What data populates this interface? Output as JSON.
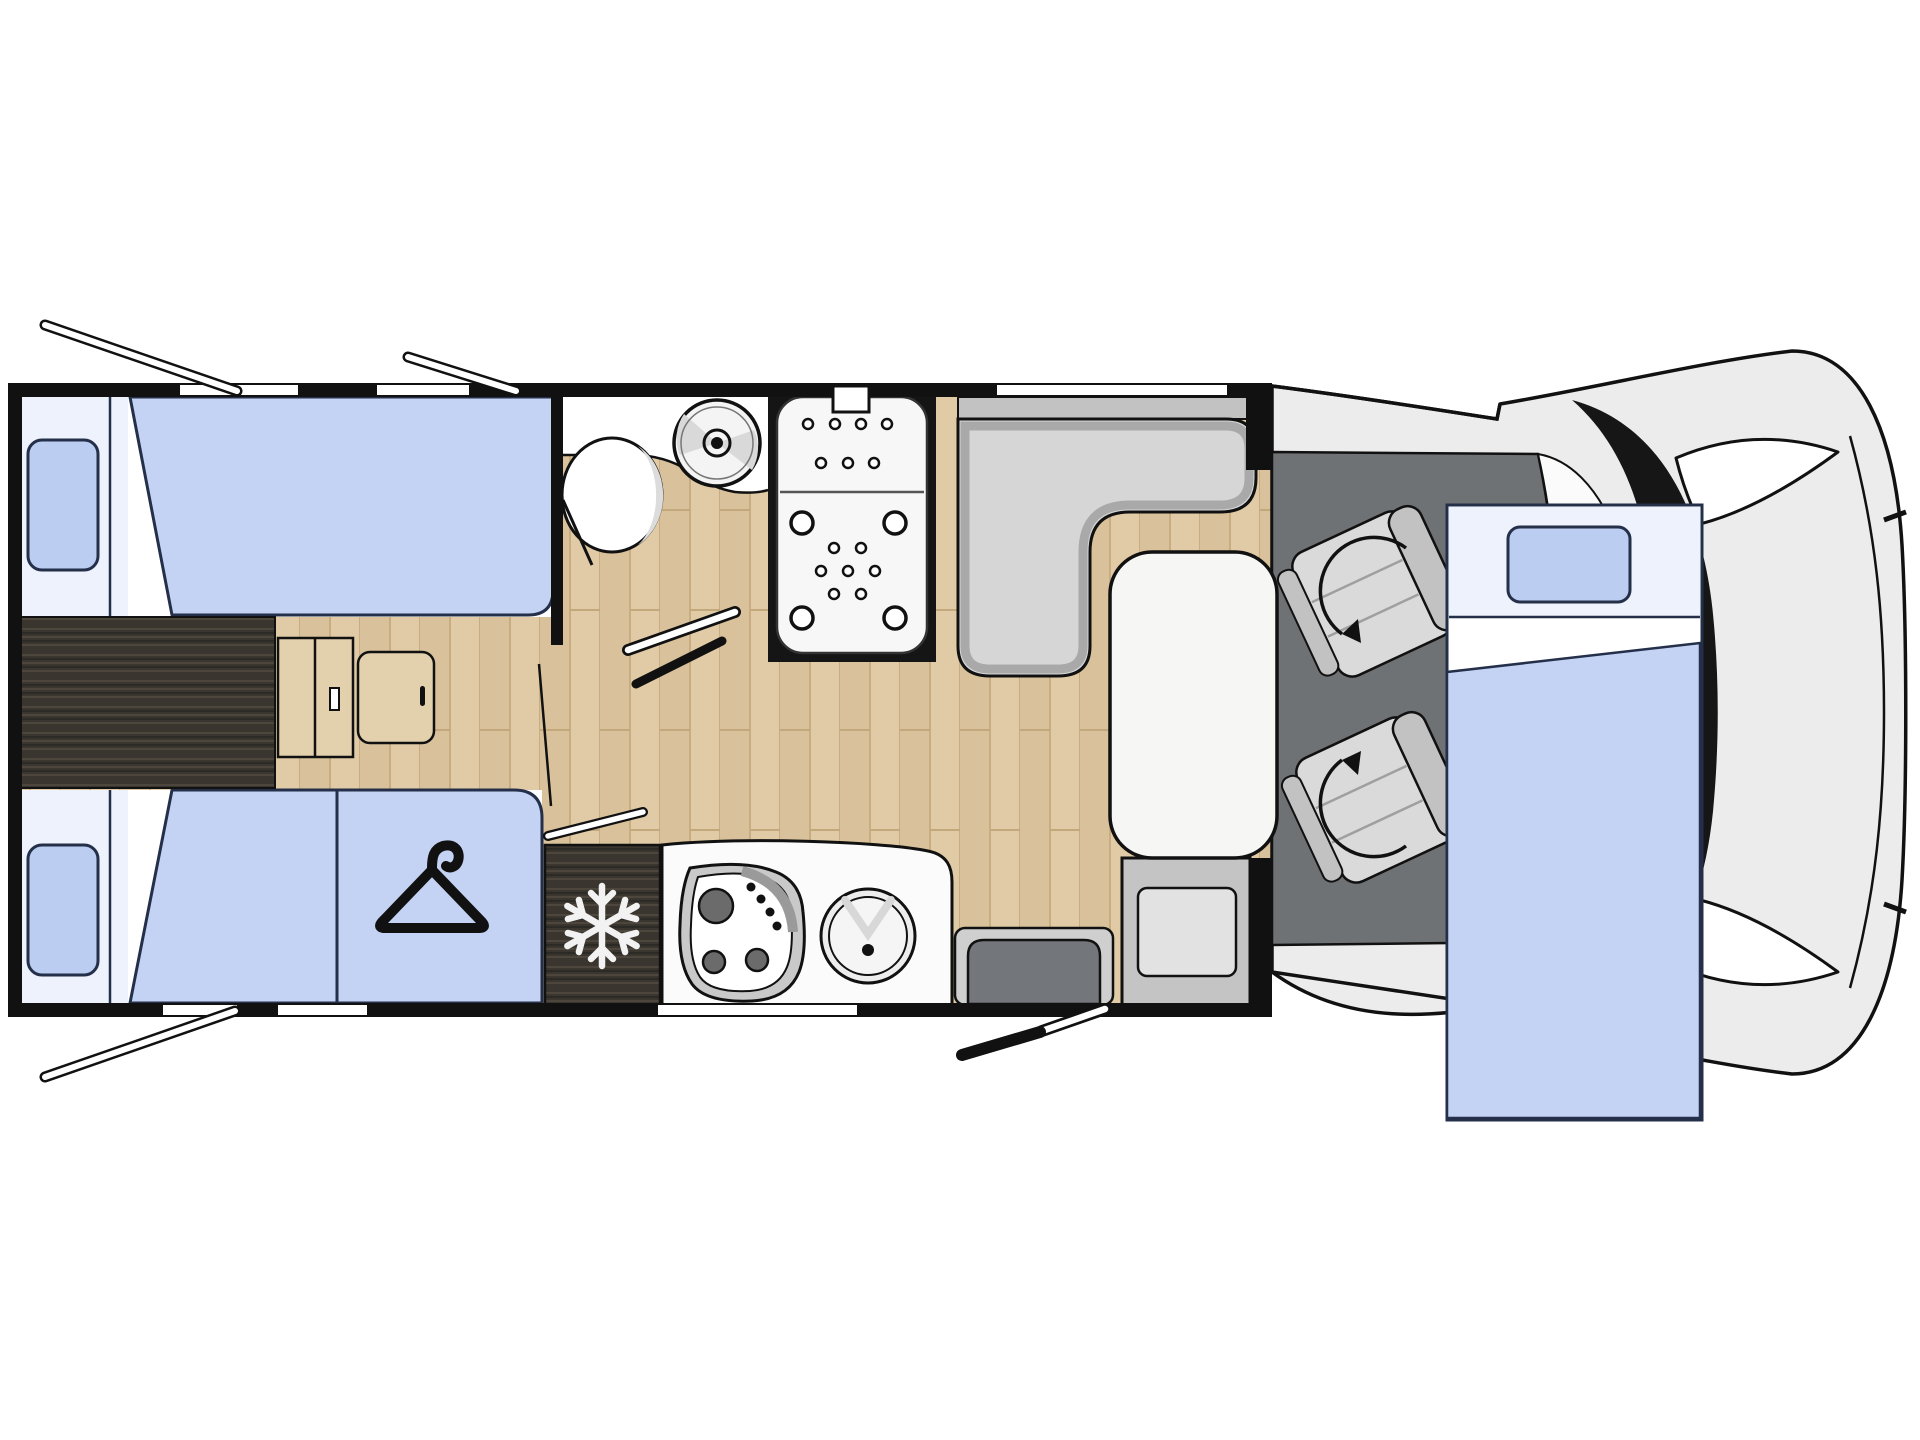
{
  "meta": {
    "title": "Motorhome floor plan (top-down layout diagram)",
    "orientation": "vehicle nose on the right, rear on the left"
  },
  "colors": {
    "background": "#ffffff",
    "wall": "#111111",
    "floor_wood": "#e0cba6",
    "floor_wood_shade": "#d8c098",
    "dark_wood": "#3a362f",
    "mattress_blue": "#c4d2f4",
    "pillow_blue": "#bccdf2",
    "bed_head": "#eef2fc",
    "outline_navy": "#242f49",
    "seat_light": "#d6d6d6",
    "seat_band": "#c2c2c2",
    "backrest_gray": "#73767a",
    "cab_floor": "#6f7274",
    "body_gray": "#ececec",
    "windshield": "#161616",
    "table_white": "#f6f6f4",
    "counter_white": "#fbfbfb",
    "fixture_white": "#ffffff",
    "tray_white": "#f7f7f7",
    "burner_gray": "#6b6b6b",
    "step_gray": "#c4c4c4",
    "step_inner": "#e2e2e2"
  },
  "icons": [
    {
      "name": "snowflake-icon",
      "meaning": "refrigerator / freezer"
    },
    {
      "name": "hanger-icon",
      "meaning": "wardrobe under foot of bed"
    },
    {
      "name": "swivel-arrow-icon",
      "meaning": "rotating cab seat (driver & passenger)"
    },
    {
      "name": "open-window-icon",
      "meaning": "opening window flap on wall"
    },
    {
      "name": "door-swing-icon",
      "meaning": "door shown with opening swing"
    }
  ],
  "areas": [
    {
      "name": "rear-twin-single-beds",
      "description": "two single beds with pillows, rear left"
    },
    {
      "name": "center-platform",
      "description": "dark wood step platform between beds"
    },
    {
      "name": "wardrobe",
      "description": "blue panel with hanger icon at foot of lower bed"
    },
    {
      "name": "bathroom",
      "description": "toilet, round washbasin and counter"
    },
    {
      "name": "shower",
      "description": "shower tray with drain dots"
    },
    {
      "name": "kitchen",
      "description": "fridge, 3-burner hob and round sink"
    },
    {
      "name": "dinette",
      "description": "L-shaped sofa with white table"
    },
    {
      "name": "entry-door",
      "description": "habitation door with swing, bottom right"
    },
    {
      "name": "cab",
      "description": "two swivel seats on dark cab floor"
    },
    {
      "name": "drop-down-bed",
      "description": "front drop-down bed overlapping the cab"
    },
    {
      "name": "vehicle-front",
      "description": "cab body, windshield and headlights"
    }
  ]
}
